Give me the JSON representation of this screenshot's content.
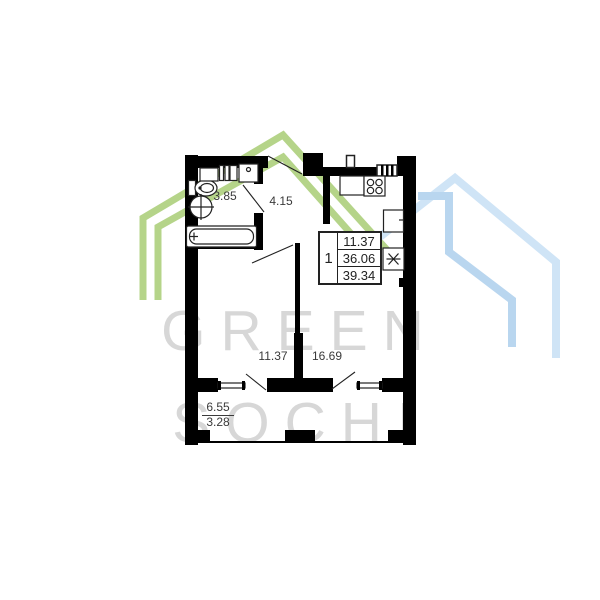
{
  "watermark": {
    "line1": "GREEN",
    "line2": "SOCHI"
  },
  "colors": {
    "wall": "#000000",
    "line": "#222222",
    "label": "#3a3a3a",
    "watermark_text": "#d7d7d7",
    "house_green": "#b5d489",
    "house_blue": "#cfe4f6",
    "house_blue_inner": "#b9d6ef"
  },
  "plan": {
    "apartment_info": {
      "rooms_count": "1",
      "living_area": "11.37",
      "area_without_balcony": "36.06",
      "total_area": "39.34"
    },
    "rooms": {
      "bathroom": {
        "area": "3.85"
      },
      "hallway": {
        "area": "4.15"
      },
      "bedroom": {
        "area": "11.37"
      },
      "kitchen_living": {
        "area": "16.69"
      },
      "balcony": {
        "area_full": "6.55",
        "area_reduced": "3.28"
      }
    },
    "fixture_icons": [
      "bathtub-icon",
      "toilet-icon",
      "round-sink-icon",
      "vanity-icon",
      "washing-machine-icon",
      "stove-icon",
      "kitchen-sink-icon",
      "fridge-icon",
      "snowflake-icon",
      "vent-shaft-icon"
    ]
  }
}
